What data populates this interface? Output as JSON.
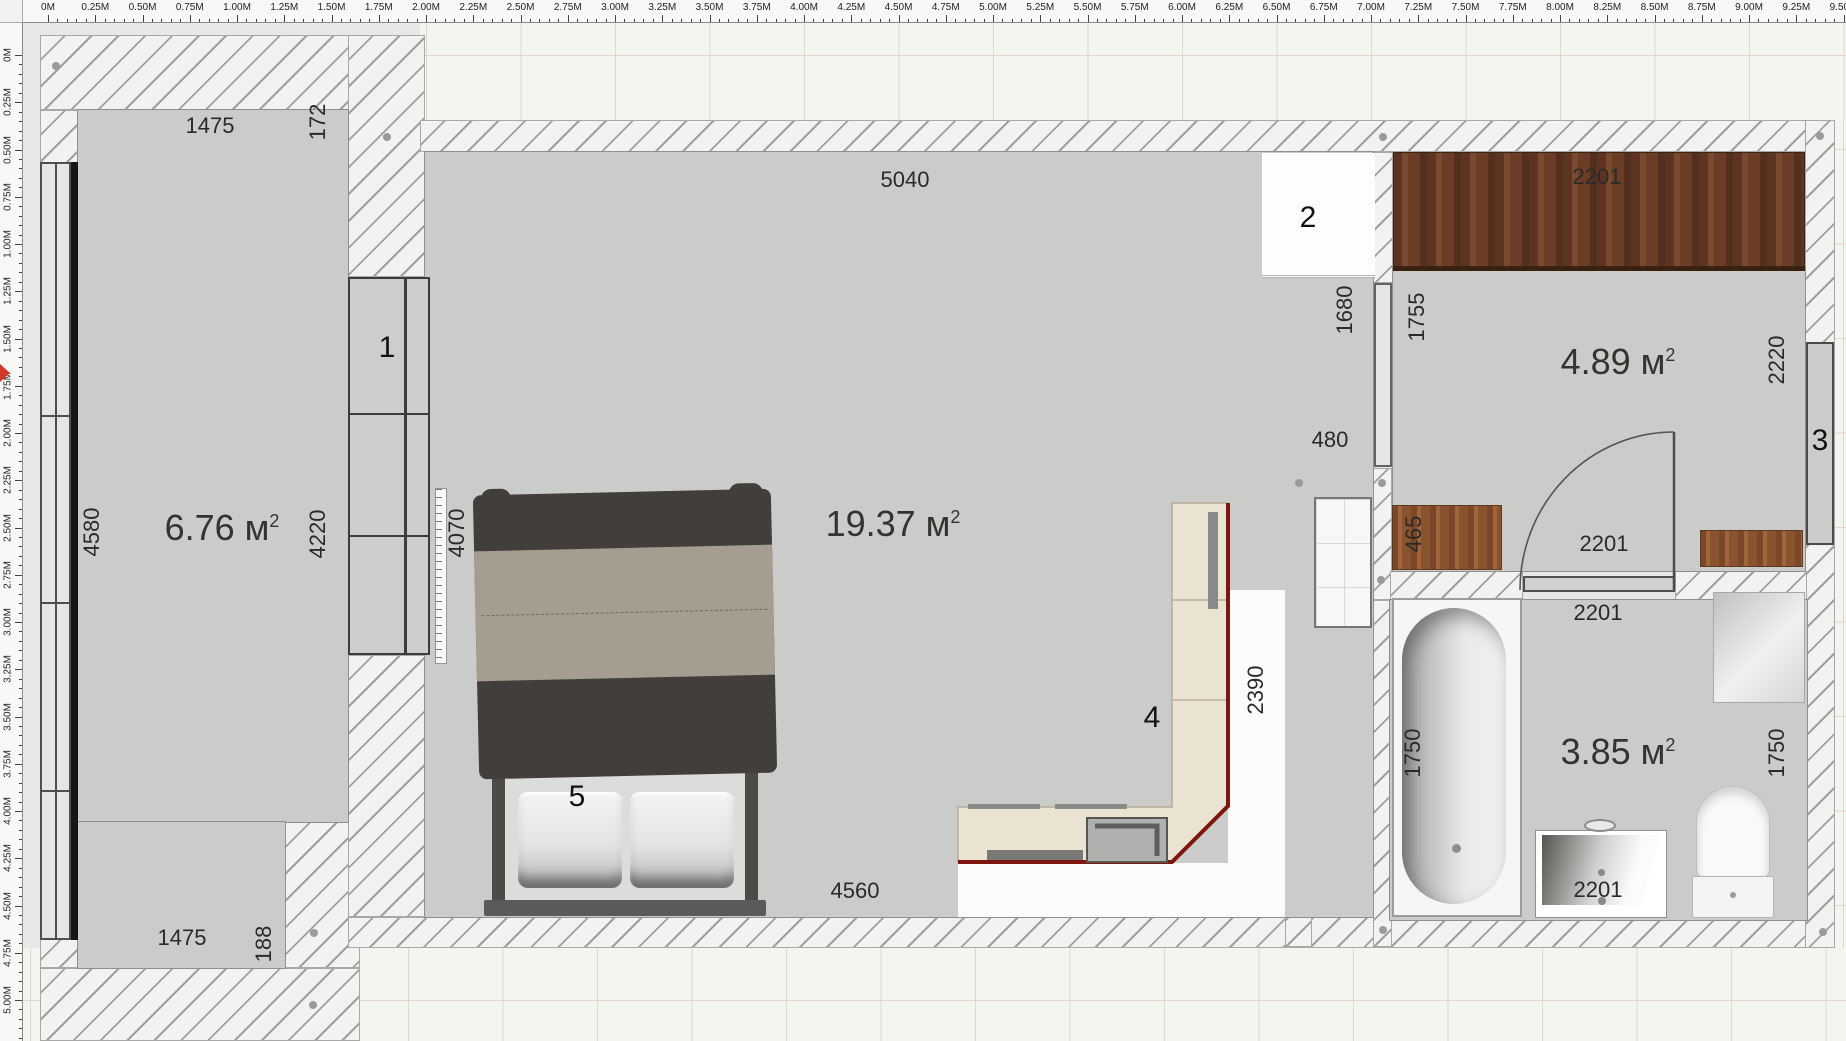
{
  "app": {
    "view_name": "floor-plan-2d"
  },
  "colors": {
    "accent_red": "#7e150f",
    "floor_gray": "#cbcbc9",
    "wall_hatch_line": "#9f9f9d",
    "wood_dark": "#6b3a24",
    "wood_light": "#8a5330",
    "marker_red": "#d0392b"
  },
  "rulers": {
    "top": {
      "labels": [
        "0М",
        "0.25М",
        "0.50М",
        "0.75М",
        "1.00М",
        "1.25М",
        "1.50М",
        "1.75М",
        "2.00М",
        "2.25М",
        "2.50М",
        "2.75М",
        "3.00М",
        "3.25М",
        "3.50М",
        "3.75М",
        "4.00М",
        "4.25М",
        "4.50М",
        "4.75М",
        "5.00М",
        "5.25М",
        "5.50М",
        "5.75М",
        "6.00М",
        "6.25М",
        "6.50М",
        "6.75М",
        "7.00М",
        "7.25М",
        "7.50М",
        "7.75М",
        "8.00М",
        "8.25М",
        "8.50М",
        "8.75М",
        "9.00М",
        "9.25М",
        "9.50М"
      ]
    },
    "left": {
      "labels": [
        "0М",
        "0.25М",
        "0.50М",
        "0.75М",
        "1.00М",
        "1.25М",
        "1.50М",
        "1.75М",
        "2.00М",
        "2.25М",
        "2.50М",
        "2.75М",
        "3.00М",
        "3.25М",
        "3.50М",
        "3.75М",
        "4.00М",
        "4.25М",
        "4.50М",
        "4.75М",
        "5.00М"
      ]
    }
  },
  "areas": {
    "balcony": {
      "v": "6.76 м",
      "sup": "2"
    },
    "living": {
      "v": "19.37 м",
      "sup": "2"
    },
    "hall": {
      "v": "4.89 м",
      "sup": "2"
    },
    "bath": {
      "v": "3.85 м",
      "sup": "2"
    }
  },
  "dims": {
    "balcony_top": "1475",
    "balcony_top_off": "172",
    "balcony_left": "4580",
    "balcony_right": "4220",
    "balcony_bottom": "1475",
    "balcony_bottom_off": "188",
    "living_top": "5040",
    "living_left": "4070",
    "living_bottom": "4560",
    "living_right": "1680",
    "opening": "480",
    "hall_left": "1755",
    "hall_right": "2220",
    "hall_wardrobe": "2201",
    "hall_cabinet": "465",
    "hall_door": "2201",
    "bath_top": "2201",
    "bath_tub": "1750",
    "bath_right": "1750",
    "bath_sink": "2201",
    "kitchen_side": "2390"
  },
  "markers": {
    "wardrobe": "1",
    "fridge": "2",
    "window": "3",
    "kitchen": "4",
    "bed": "5"
  }
}
